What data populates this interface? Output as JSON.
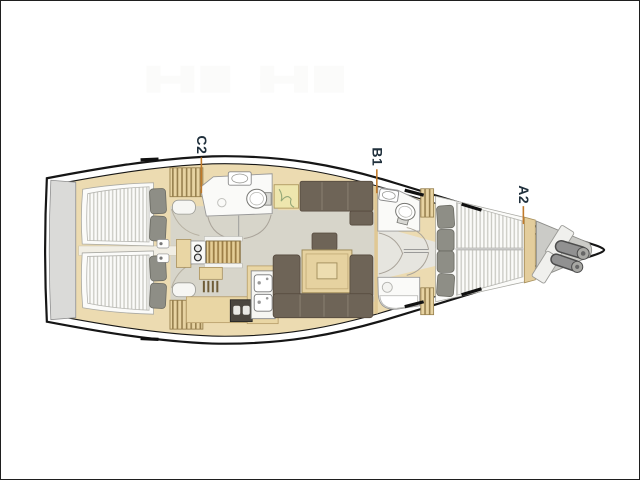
{
  "plan": {
    "labels": {
      "c2": "C2",
      "b1": "B1",
      "a2": "A2"
    },
    "colors": {
      "background": "#ffffff",
      "hull_outline": "#161616",
      "deck_wood": "#ecdbb1",
      "furniture_wood": "#e9d6a4",
      "floor_gray": "#d7d5ca",
      "upholstery_brown": "#6e6457",
      "pillow_gray": "#8e8e86",
      "mattress_stripe": "#c9c9c2",
      "platform_gray": "#dadad8",
      "room_white": "#fafaf8",
      "anchor_locker_gray": "#cbcbc7",
      "windlass_steel": "#919191",
      "label_text": "#20303c",
      "leader_line": "#c07a2b"
    }
  }
}
